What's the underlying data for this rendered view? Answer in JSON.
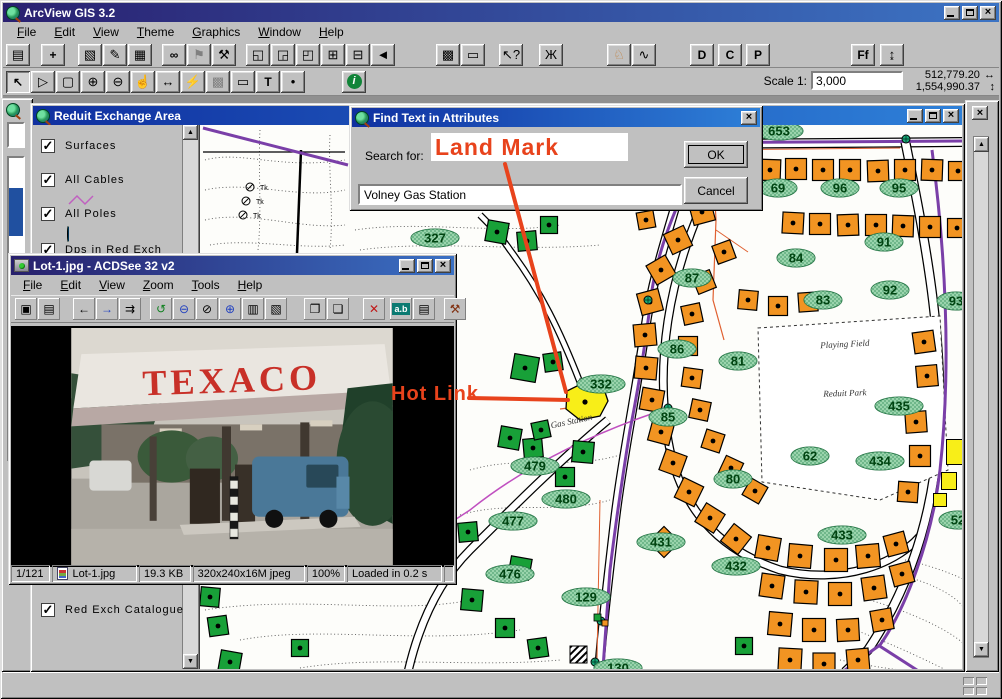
{
  "app": {
    "title": "ArcView GIS 3.2",
    "menus": [
      "File",
      "Edit",
      "View",
      "Theme",
      "Graphics",
      "Window",
      "Help"
    ],
    "toolbar1": [
      {
        "n": "save-project",
        "g": "▤"
      },
      {
        "gap": 10
      },
      {
        "n": "add-theme",
        "g": "+",
        "bold": true
      },
      {
        "gap": 12
      },
      {
        "n": "theme-properties",
        "g": "▧"
      },
      {
        "n": "edit-legend",
        "g": "✎"
      },
      {
        "n": "open-theme-table",
        "g": "▦"
      },
      {
        "gap": 9
      },
      {
        "n": "find",
        "g": "∞",
        "bold": true
      },
      {
        "n": "locate-address",
        "g": "⚑",
        "gray": true
      },
      {
        "n": "query-builder",
        "g": "⚒"
      },
      {
        "gap": 9
      },
      {
        "n": "zoom-full-extent",
        "g": "◱"
      },
      {
        "n": "zoom-active-theme",
        "g": "◲"
      },
      {
        "n": "zoom-selected",
        "g": "◰"
      },
      {
        "n": "zoom-in-extent",
        "g": "⊞"
      },
      {
        "n": "zoom-out-extent",
        "g": "⊟"
      },
      {
        "n": "zoom-previous",
        "g": "◄"
      },
      {
        "gap": 40
      },
      {
        "n": "select-features",
        "g": "▩"
      },
      {
        "n": "clear-selection",
        "g": "▭"
      },
      {
        "gap": 13
      },
      {
        "n": "help",
        "g": "↖?"
      },
      {
        "gap": 15
      },
      {
        "n": "dialog-designer-bug",
        "g": "Ж"
      },
      {
        "gap": 43
      },
      {
        "n": "extension-dog",
        "g": "♘",
        "color": "#c08040"
      },
      {
        "n": "chart-pen",
        "g": "∿"
      },
      {
        "gap": 33
      },
      {
        "n": "button-D",
        "g": "D",
        "bold": true
      },
      {
        "gap": 3
      },
      {
        "n": "button-C",
        "g": "C",
        "bold": true
      },
      {
        "gap": 3
      },
      {
        "n": "button-P",
        "g": "P",
        "bold": true
      },
      {
        "gap": 80
      },
      {
        "n": "font-tool",
        "g": "Ff",
        "bold": true
      },
      {
        "gap": 4
      },
      {
        "n": "pole-tool",
        "g": "↨"
      }
    ],
    "toolbar2": [
      {
        "n": "pointer-tool",
        "g": "↖",
        "bold": true,
        "pressed": true
      },
      {
        "n": "vertex-edit-tool",
        "g": "▷"
      },
      {
        "n": "select-box-tool",
        "g": "▢"
      },
      {
        "n": "zoom-in-tool",
        "g": "⊕"
      },
      {
        "n": "zoom-out-tool",
        "g": "⊖"
      },
      {
        "n": "pan-tool",
        "g": "☝"
      },
      {
        "n": "measure-tool",
        "g": "↔"
      },
      {
        "n": "hotlink-tool",
        "g": "⚡"
      },
      {
        "n": "neighborhood-tool",
        "g": "▩",
        "gray": true
      },
      {
        "n": "callout-tool",
        "g": "▭"
      },
      {
        "n": "text-tool",
        "g": "T",
        "bold": true
      },
      {
        "n": "draw-point-tool",
        "g": "•"
      }
    ],
    "scale_label": "Scale 1:",
    "scale_value": "3,000",
    "coord_x": "512,779.20",
    "coord_y": "1,554,990.37",
    "coord_x_arrow": "↔",
    "coord_y_arrow": "↕"
  },
  "view_window": {
    "title": "Reduit Exchange Area",
    "toc": [
      {
        "label": "Surfaces",
        "checked": true,
        "sym": "none",
        "y": 14
      },
      {
        "label": "All Cables",
        "checked": true,
        "sym": "zigzag",
        "y": 48
      },
      {
        "label": "All Poles",
        "checked": true,
        "sym": "pole",
        "y": 82
      },
      {
        "label": "Dps in Red Exch",
        "checked": true,
        "sym": "none",
        "y": 118
      },
      {
        "label": "Red Exch Catalogue",
        "checked": true,
        "sym": "none",
        "y": 478
      }
    ]
  },
  "find_dialog": {
    "title": "Find Text in Attributes",
    "search_label": "Search for:",
    "search_value": "Volney Gas Station",
    "ok_label": "OK",
    "cancel_label": "Cancel"
  },
  "annotations": {
    "land_mark": "Land Mark",
    "hot_link": "Hot Link",
    "color": "#e8431c"
  },
  "acdsee": {
    "title": "Lot-1.jpg - ACDSee 32 v2",
    "menus": [
      "File",
      "Edit",
      "View",
      "Zoom",
      "Tools",
      "Help"
    ],
    "toolbar": [
      {
        "n": "browse-icon",
        "g": "▣"
      },
      {
        "n": "open-icon",
        "g": "▤"
      },
      {
        "gap": 12
      },
      {
        "n": "prev-image-icon",
        "g": "←",
        "gray": true
      },
      {
        "n": "next-image-icon",
        "g": "→",
        "color": "#2040c0"
      },
      {
        "n": "slideshow-icon",
        "g": "⇉"
      },
      {
        "gap": 8
      },
      {
        "n": "refresh-icon",
        "g": "↺",
        "color": "#108020",
        "bold": true
      },
      {
        "n": "zoom-out-icon",
        "g": "⊖",
        "color": "#2040c0"
      },
      {
        "n": "zoom-fit-icon",
        "g": "⊘",
        "gray": true
      },
      {
        "n": "zoom-in-icon",
        "g": "⊕",
        "color": "#2040c0"
      },
      {
        "n": "print-icon",
        "g": "▥"
      },
      {
        "n": "acquire-icon",
        "g": "▧"
      },
      {
        "gap": 16
      },
      {
        "n": "copy-icon",
        "g": "❐"
      },
      {
        "n": "move-icon",
        "g": "❏"
      },
      {
        "gap": 13
      },
      {
        "n": "delete-icon",
        "g": "✕",
        "color": "#c01818",
        "bold": true
      },
      {
        "gap": 4
      },
      {
        "n": "rename-icon",
        "g": "a.b",
        "chip": true
      },
      {
        "n": "describe-icon",
        "g": "▤"
      },
      {
        "gap": 8
      },
      {
        "n": "tools-icon",
        "g": "⚒",
        "color": "#803010"
      }
    ],
    "photo_brand": "TEXACO",
    "status": [
      "1/121",
      "Lot-1.jpg",
      "19.3 KB",
      "320x240x16M jpeg",
      "100%",
      "Loaded in 0.2 s"
    ]
  },
  "map": {
    "colors": {
      "orange": "#f29422",
      "green": "#18a038",
      "yellow": "#f8ee18",
      "label_fill": "#9ad4ac",
      "label_edge": "#1e6e3e",
      "cable": "#7a3fa8",
      "thin_cable": "#e06030",
      "magenta_cable": "#c050c0"
    },
    "labels": [
      [
        "653",
        779,
        131
      ],
      [
        "69",
        778,
        188
      ],
      [
        "96",
        840,
        188
      ],
      [
        "95",
        899,
        188
      ],
      [
        "87",
        692,
        278
      ],
      [
        "84",
        796,
        258
      ],
      [
        "91",
        884,
        242
      ],
      [
        "92",
        890,
        290
      ],
      [
        "83",
        823,
        300
      ],
      [
        "93",
        956,
        301
      ],
      [
        "86",
        677,
        349
      ],
      [
        "81",
        738,
        361
      ],
      [
        "85",
        668,
        417
      ],
      [
        "435",
        899,
        406
      ],
      [
        "62",
        810,
        456
      ],
      [
        "434",
        880,
        461
      ],
      [
        "80",
        733,
        479
      ],
      [
        "52",
        958,
        520
      ],
      [
        "433",
        842,
        535
      ],
      [
        "332",
        601,
        384
      ],
      [
        "327",
        435,
        238
      ],
      [
        "479",
        535,
        466
      ],
      [
        "480",
        566,
        499
      ],
      [
        "477",
        513,
        521
      ],
      [
        "431",
        661,
        542
      ],
      [
        "432",
        736,
        566
      ],
      [
        "476",
        510,
        574
      ],
      [
        "129",
        586,
        597
      ],
      [
        "130",
        618,
        668
      ]
    ],
    "texts": [
      [
        "Playing Field",
        845,
        347,
        -3
      ],
      [
        "Reduit Park",
        845,
        396,
        -2
      ],
      [
        "Gas Station",
        572,
        424,
        -12
      ]
    ],
    "orange": [
      [
        770,
        170,
        21,
        2
      ],
      [
        796,
        169,
        21,
        0
      ],
      [
        823,
        170,
        21,
        0
      ],
      [
        850,
        170,
        21,
        0
      ],
      [
        878,
        171,
        21,
        -2
      ],
      [
        905,
        170,
        21,
        0
      ],
      [
        932,
        170,
        21,
        2
      ],
      [
        958,
        171,
        19,
        0
      ],
      [
        793,
        223,
        21,
        3
      ],
      [
        820,
        224,
        21,
        0
      ],
      [
        848,
        225,
        21,
        -2
      ],
      [
        876,
        225,
        21,
        0
      ],
      [
        903,
        226,
        21,
        2
      ],
      [
        930,
        227,
        21,
        0
      ],
      [
        957,
        228,
        19,
        0
      ],
      [
        702,
        212,
        22,
        -15
      ],
      [
        678,
        240,
        22,
        -25
      ],
      [
        661,
        270,
        22,
        -30
      ],
      [
        650,
        302,
        22,
        -15
      ],
      [
        645,
        335,
        22,
        -5
      ],
      [
        646,
        368,
        22,
        5
      ],
      [
        652,
        400,
        22,
        10
      ],
      [
        661,
        432,
        22,
        15
      ],
      [
        673,
        463,
        22,
        20
      ],
      [
        689,
        492,
        22,
        26
      ],
      [
        710,
        518,
        22,
        32
      ],
      [
        736,
        539,
        22,
        38
      ],
      [
        724,
        252,
        19,
        -20
      ],
      [
        704,
        282,
        19,
        -22
      ],
      [
        692,
        314,
        19,
        -12
      ],
      [
        688,
        346,
        19,
        0
      ],
      [
        692,
        378,
        19,
        8
      ],
      [
        700,
        410,
        19,
        12
      ],
      [
        713,
        441,
        19,
        18
      ],
      [
        731,
        468,
        19,
        25
      ],
      [
        755,
        491,
        19,
        30
      ],
      [
        748,
        300,
        19,
        5
      ],
      [
        778,
        306,
        19,
        0
      ],
      [
        808,
        302,
        19,
        -4
      ],
      [
        646,
        220,
        17,
        -10
      ],
      [
        924,
        342,
        21,
        -8
      ],
      [
        927,
        376,
        21,
        -5
      ],
      [
        916,
        422,
        21,
        -4
      ],
      [
        920,
        456,
        21,
        0
      ],
      [
        908,
        492,
        20,
        4
      ],
      [
        768,
        548,
        23,
        10
      ],
      [
        800,
        556,
        23,
        5
      ],
      [
        836,
        560,
        23,
        0
      ],
      [
        868,
        556,
        23,
        -5
      ],
      [
        896,
        544,
        21,
        -15
      ],
      [
        772,
        586,
        23,
        8
      ],
      [
        806,
        592,
        23,
        3
      ],
      [
        840,
        594,
        23,
        0
      ],
      [
        874,
        588,
        23,
        -8
      ],
      [
        902,
        574,
        21,
        -15
      ],
      [
        780,
        624,
        23,
        5
      ],
      [
        814,
        630,
        23,
        0
      ],
      [
        848,
        630,
        22,
        -3
      ],
      [
        882,
        620,
        21,
        -10
      ],
      [
        790,
        660,
        23,
        3
      ],
      [
        824,
        664,
        22,
        0
      ],
      [
        858,
        660,
        22,
        -5
      ],
      [
        664,
        542,
        22,
        45
      ]
    ],
    "green": [
      [
        497,
        232,
        21,
        10
      ],
      [
        527,
        241,
        19,
        -5
      ],
      [
        549,
        225,
        17,
        0
      ],
      [
        677,
        185,
        15,
        10
      ],
      [
        525,
        368,
        25,
        10
      ],
      [
        553,
        362,
        18,
        -8
      ],
      [
        585,
        384,
        10,
        0
      ],
      [
        510,
        438,
        21,
        10
      ],
      [
        533,
        448,
        19,
        -5
      ],
      [
        583,
        452,
        21,
        5
      ],
      [
        565,
        477,
        19,
        0
      ],
      [
        541,
        430,
        17,
        -12
      ],
      [
        468,
        532,
        19,
        -5
      ],
      [
        520,
        568,
        21,
        10
      ],
      [
        472,
        600,
        21,
        5
      ],
      [
        505,
        628,
        19,
        0
      ],
      [
        538,
        648,
        19,
        -8
      ],
      [
        210,
        597,
        19,
        5
      ],
      [
        218,
        626,
        19,
        -8
      ],
      [
        230,
        662,
        21,
        10
      ],
      [
        300,
        648,
        17,
        0
      ],
      [
        744,
        646,
        17,
        0
      ]
    ],
    "yellow": [
      [
        955,
        452,
        17,
        25
      ],
      [
        949,
        481,
        15,
        17
      ],
      [
        940,
        500,
        13,
        13
      ]
    ],
    "poles": [
      [
        712,
        141
      ],
      [
        668,
        408
      ],
      [
        906,
        139
      ],
      [
        601,
        621
      ],
      [
        595,
        662
      ],
      [
        648,
        300
      ]
    ],
    "gas_polygon": "567,391 583,383 603,386 608,401 600,416 580,420 566,409",
    "gas_dot": [
      585,
      402
    ]
  }
}
